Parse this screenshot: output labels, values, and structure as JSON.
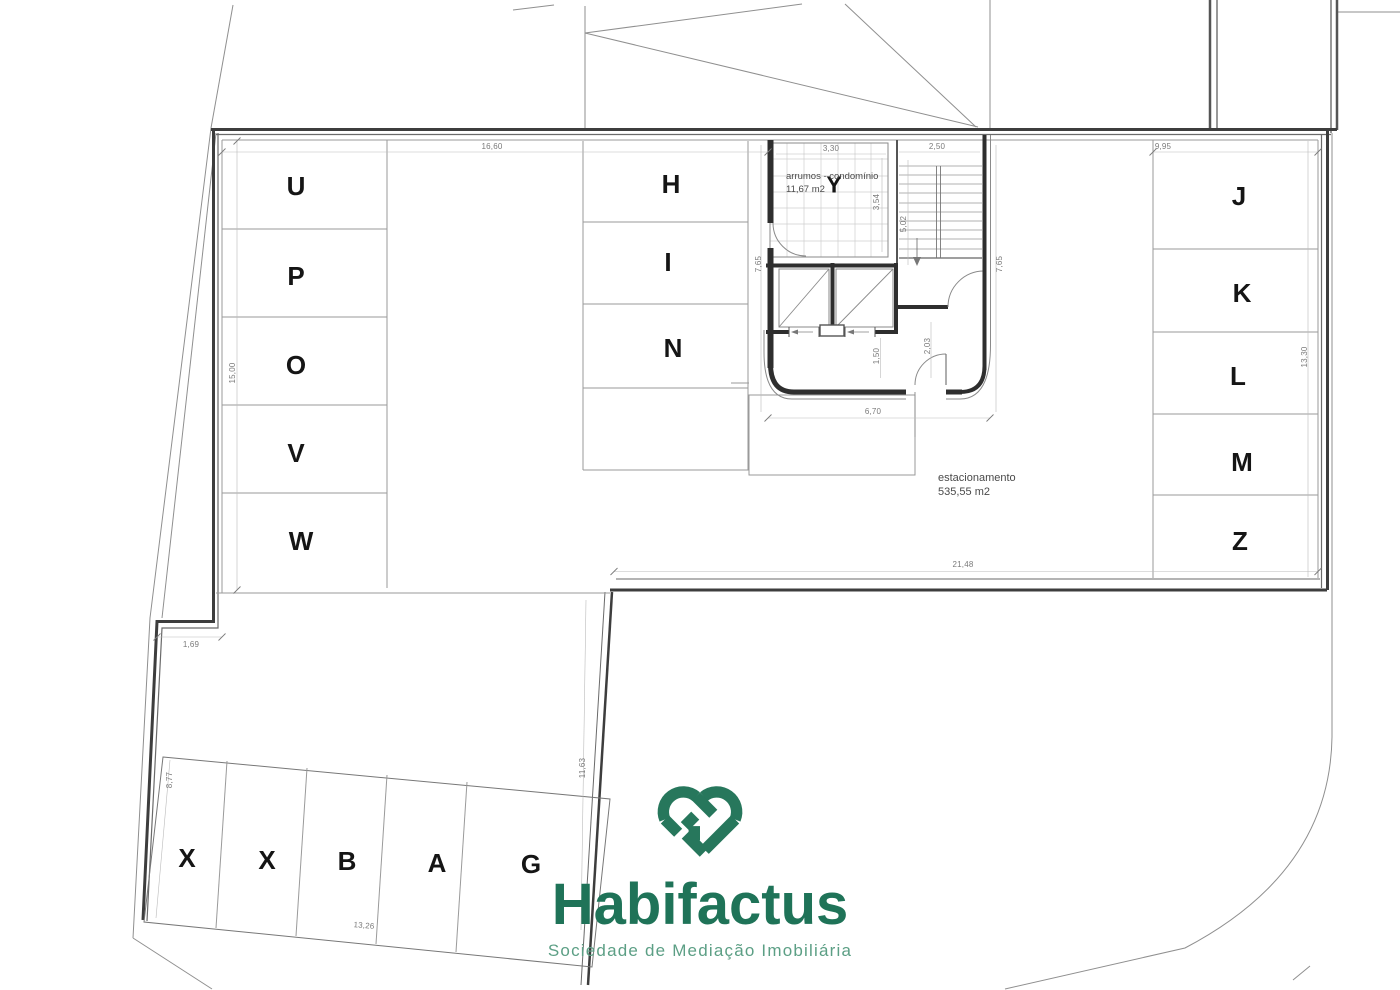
{
  "plan": {
    "stall_letters": {
      "left": [
        "U",
        "P",
        "O",
        "V",
        "W"
      ],
      "middle": [
        "H",
        "I",
        "N"
      ],
      "right": [
        "J",
        "K",
        "L",
        "M",
        "Z"
      ],
      "bottom": [
        "X",
        "X",
        "B",
        "A",
        "G"
      ],
      "core": "Y"
    },
    "texts": {
      "storage_line1": "arrumos - condomínio",
      "storage_line2": "11,67  m2",
      "parking_line1": "estacionamento",
      "parking_line2": "535,55  m2"
    },
    "dims": {
      "d1660": "16,60",
      "d995": "9,95",
      "d330": "3,30",
      "d250": "2,50",
      "d1500": "15,00",
      "d354": "3,54",
      "d502": "5,02",
      "d765l": "7,65",
      "d765r": "7,65",
      "d150": "1,50",
      "d203": "2,03",
      "d670": "6,70",
      "d2148": "21,48",
      "d169": "1,69",
      "d1330": "13,30",
      "d877": "8,77",
      "d1326": "13,26",
      "d1163": "11,63"
    },
    "colors": {
      "wall": "#3d3d3d",
      "thin_line": "#8f8f8f",
      "grid": "#cfcfcf",
      "dim_text": "#7a7a7a",
      "letter_text": "#151515"
    }
  },
  "logo": {
    "name": "Habifactus",
    "tagline": "Sociedade de Mediação Imobiliária",
    "icon": "heart-ribbon",
    "color_primary": "#1f7358",
    "color_secondary": "#5c9f85"
  }
}
